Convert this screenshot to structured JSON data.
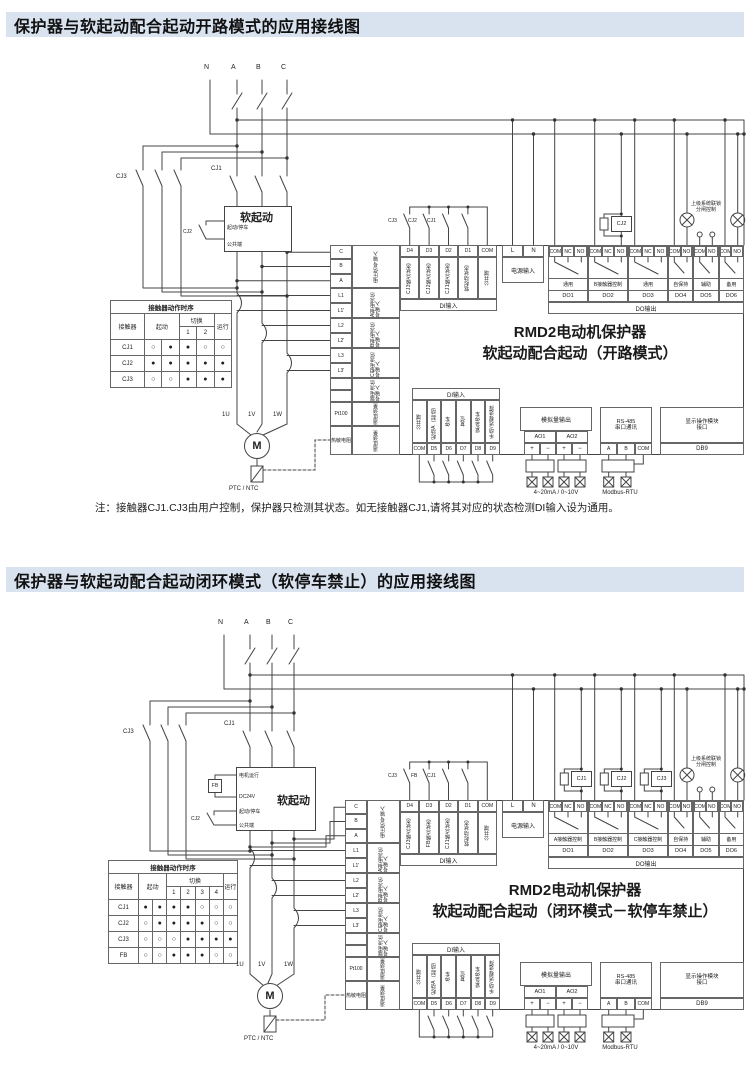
{
  "colors": {
    "title_bg": "#d9e3f0",
    "wire": "#444444",
    "ink": "#222222"
  },
  "panel1": {
    "title": "保护器与软起动配合起动开路模式的应用接线图",
    "phases": [
      "N",
      "A",
      "B",
      "C"
    ],
    "cj3": "CJ3",
    "cj1": "CJ1",
    "cj2": "CJ2",
    "soft": {
      "title": "软起动",
      "ports": [
        "起动/停车",
        "公共端"
      ]
    },
    "seq": {
      "title": "接触器动作时序",
      "h_contactor": "接触器",
      "h_start": "起动",
      "h_switch": "切换",
      "h_run": "运行",
      "subs": [
        "1",
        "2"
      ],
      "rows": [
        [
          "CJ1",
          "○",
          "●",
          "●",
          "○",
          "○"
        ],
        [
          "CJ2",
          "●",
          "●",
          "●",
          "●",
          "●"
        ],
        [
          "CJ3",
          "○",
          "○",
          "●",
          "●",
          "●"
        ]
      ]
    },
    "motor": {
      "m": "M",
      "t": [
        "1U",
        "1V",
        "1W"
      ],
      "ptc": "PTC / NTC"
    },
    "left": [
      {
        "terms": [
          "C",
          "B",
          "A"
        ],
        "label": "电压信号输入"
      },
      {
        "terms": [
          "L1",
          "L1'"
        ],
        "label": "A相电流信号输入"
      },
      {
        "terms": [
          "L2",
          "L2'"
        ],
        "label": "B相电流信号输入"
      },
      {
        "terms": [
          "L3",
          "L3'"
        ],
        "label": "C相电流信号输入"
      },
      {
        "terms": [
          "",
          ""
        ],
        "label": "漏电流信号输入"
      },
      {
        "terms": [
          "Pt100"
        ],
        "label": "温度测量"
      },
      {
        "terms": [
          "热敏电阻"
        ],
        "label": "温度测量"
      }
    ],
    "di_top": {
      "bar": "DI输入",
      "terms": [
        "D4",
        "D3",
        "D2",
        "D1",
        "COM"
      ],
      "labels": [
        "CJ3触点状态",
        "CJ2触点状态",
        "CJ1触点状态",
        "软起动状态",
        "公共端"
      ],
      "contacts": [
        "CJ3",
        "CJ2",
        "CJ1"
      ]
    },
    "power": {
      "terms": [
        "L",
        "N"
      ],
      "label": "电源输入"
    },
    "do": {
      "bar": "DO输出",
      "coil": "CJ2",
      "interlock": [
        "上级系统联锁",
        "分闸控制"
      ],
      "groups": [
        {
          "terms": [
            "COM",
            "NC",
            "NO"
          ],
          "label": "通用",
          "name": "DO1"
        },
        {
          "terms": [
            "COM",
            "NC",
            "NO"
          ],
          "label": "B接触器控制",
          "name": "DO2"
        },
        {
          "terms": [
            "COM",
            "NC",
            "NO"
          ],
          "label": "通用",
          "name": "DO3"
        },
        {
          "terms": [
            "COM",
            "NO"
          ],
          "label": "自保持",
          "name": "DO4"
        },
        {
          "terms": [
            "COM",
            "NO"
          ],
          "label": "辅助",
          "name": "DO5"
        },
        {
          "terms": [
            "COM",
            "NO"
          ],
          "label": "备用",
          "name": "DO6"
        }
      ]
    },
    "center": [
      "RMD2电动机保护器",
      "软起动配合起动（开路模式）"
    ],
    "di_bot": {
      "bar": "DI输入",
      "terms": [
        "COM",
        "D5",
        "D6",
        "D7",
        "D8",
        "D9"
      ],
      "labels": [
        "公共端",
        "起动A（起动）",
        "停车",
        "复位",
        "紧急停车",
        "手动/远程选择"
      ]
    },
    "ao": {
      "title": "模拟量输出",
      "subs": [
        "AO1",
        "AO2"
      ],
      "terms": [
        "+",
        "−",
        "+",
        "−"
      ],
      "caption": "4~20mA / 0~10V"
    },
    "rs": {
      "title": "RS-485",
      "title2": "串口通讯",
      "terms": [
        "A",
        "B",
        "COM"
      ],
      "caption": "Modbus-RTU"
    },
    "disp": {
      "title": "显示操作模块",
      "title2": "接口",
      "term": "DB9"
    },
    "note": "注：接触器CJ1.CJ3由用户控制，保护器只检测其状态。如无接触器CJ1,请将其对应的状态检测DI输入设为通用。"
  },
  "panel2": {
    "title": "保护器与软起动配合起动闭环模式（软停车禁止）的应用接线图",
    "phases": [
      "N",
      "A",
      "B",
      "C"
    ],
    "cj3": "CJ3",
    "cj1": "CJ1",
    "cj2": "CJ2",
    "soft": {
      "title": "软起动",
      "fb": "FB",
      "ports": [
        "电机运行",
        "DC24V",
        "起动/停车",
        "公共端"
      ]
    },
    "seq": {
      "title": "接触器动作时序",
      "h_contactor": "接触器",
      "h_start": "起动",
      "h_switch": "切换",
      "h_run": "运行",
      "subs": [
        "1",
        "2",
        "3",
        "4"
      ],
      "rows": [
        [
          "CJ1",
          "●",
          "●",
          "●",
          "●",
          "○",
          "○",
          "○"
        ],
        [
          "CJ2",
          "○",
          "●",
          "●",
          "●",
          "●",
          "○",
          "○"
        ],
        [
          "CJ3",
          "○",
          "○",
          "○",
          "●",
          "●",
          "●",
          "●"
        ],
        [
          "FB",
          "○",
          "○",
          "●",
          "●",
          "●",
          "○",
          "○"
        ]
      ]
    },
    "motor": {
      "m": "M",
      "t": [
        "1U",
        "1V",
        "1W"
      ],
      "ptc": "PTC / NTC"
    },
    "left": [
      {
        "terms": [
          "C",
          "B",
          "A"
        ],
        "label": "电压信号输入"
      },
      {
        "terms": [
          "L1",
          "L1'"
        ],
        "label": "A相电流信号输入"
      },
      {
        "terms": [
          "L2",
          "L2'"
        ],
        "label": "B相电流信号输入"
      },
      {
        "terms": [
          "L3",
          "L3'"
        ],
        "label": "C相电流信号输入"
      },
      {
        "terms": [
          "",
          ""
        ],
        "label": "漏电流信号输入"
      },
      {
        "terms": [
          "Pt100"
        ],
        "label": "温度测量"
      },
      {
        "terms": [
          "热敏电阻"
        ],
        "label": "温度测量"
      }
    ],
    "di_top": {
      "bar": "DI输入",
      "terms": [
        "D4",
        "D3",
        "D2",
        "D1",
        "COM"
      ],
      "labels": [
        "CJ3触点状态",
        "FB触点状态",
        "CJ1触点状态",
        "软起动状态",
        "公共端"
      ],
      "contacts": [
        "CJ3",
        "FB",
        "CJ1"
      ]
    },
    "power": {
      "terms": [
        "L",
        "N"
      ],
      "label": "电源输入"
    },
    "do": {
      "bar": "DO输出",
      "coils": [
        "CJ1",
        "CJ2",
        "CJ3"
      ],
      "interlock": [
        "上级系统联锁",
        "分闸控制"
      ],
      "groups": [
        {
          "terms": [
            "COM",
            "NC",
            "NO"
          ],
          "label": "A接触器控制",
          "name": "DO1"
        },
        {
          "terms": [
            "COM",
            "NC",
            "NO"
          ],
          "label": "B接触器控制",
          "name": "DO2"
        },
        {
          "terms": [
            "COM",
            "NC",
            "NO"
          ],
          "label": "C接触器控制",
          "name": "DO3"
        },
        {
          "terms": [
            "COM",
            "NO"
          ],
          "label": "自保持",
          "name": "DO4"
        },
        {
          "terms": [
            "COM",
            "NO"
          ],
          "label": "辅助",
          "name": "DO5"
        },
        {
          "terms": [
            "COM",
            "NO"
          ],
          "label": "备用",
          "name": "DO6"
        }
      ]
    },
    "center": [
      "RMD2电动机保护器",
      "软起动配合起动（闭环模式－软停车禁止）"
    ],
    "di_bot": {
      "bar": "DI输入",
      "terms": [
        "COM",
        "D5",
        "D6",
        "D7",
        "D8",
        "D9"
      ],
      "labels": [
        "公共端",
        "起动A（起动）",
        "停车",
        "复位",
        "紧急停车",
        "手动/远程选择"
      ]
    },
    "ao": {
      "title": "模拟量输出",
      "subs": [
        "AO1",
        "AO2"
      ],
      "terms": [
        "+",
        "−",
        "+",
        "−"
      ],
      "caption": "4~20mA / 0~10V"
    },
    "rs": {
      "title": "RS-485",
      "title2": "串口通讯",
      "terms": [
        "A",
        "B",
        "COM"
      ],
      "caption": "Modbus-RTU"
    },
    "disp": {
      "title": "显示操作模块",
      "title2": "接口",
      "term": "DB9"
    }
  }
}
